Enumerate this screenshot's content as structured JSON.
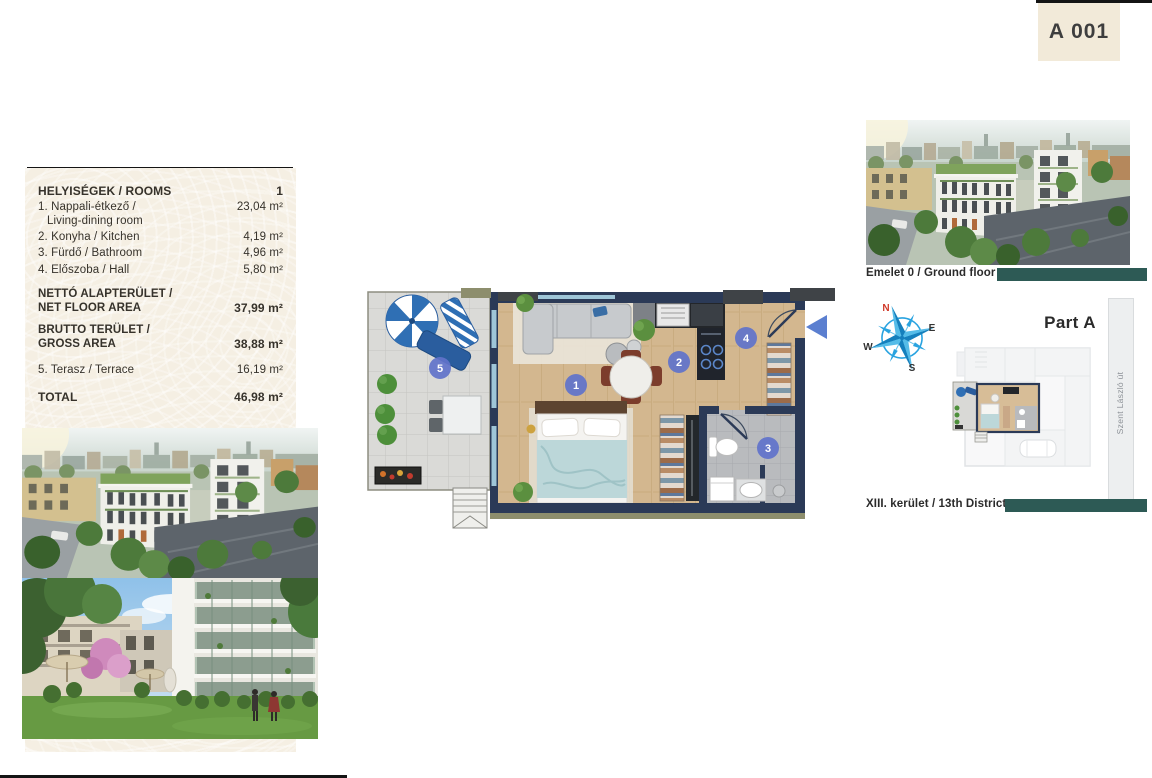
{
  "unit_badge": {
    "label": "A 001"
  },
  "rooms_table": {
    "title": "HELYISÉGEK / ROOMS",
    "unit_number": "1",
    "rows": [
      {
        "label": "1. Nappali-étkező /",
        "sub": "Living-dining room",
        "area": "23,04 m²"
      },
      {
        "label": "2. Konyha / Kitchen",
        "area": "4,19 m²"
      },
      {
        "label": "3. Fürdő / Bathroom",
        "area": "4,96 m²"
      },
      {
        "label": "4. Előszoba / Hall",
        "area": "5,80 m²"
      }
    ],
    "net": {
      "line1": "NETTÓ ALAPTERÜLET /",
      "line2": "NET FLOOR AREA",
      "area": "37,99 m²"
    },
    "gross": {
      "line1": "BRUTTO TERÜLET /",
      "line2": "GROSS AREA",
      "area": "38,88 m²"
    },
    "terrace": {
      "label": "5. Terasz / Terrace",
      "area": "16,19 m²"
    },
    "total": {
      "label": "TOTAL",
      "area": "46,98 m²"
    }
  },
  "floor_plan": {
    "markers": [
      {
        "n": "1",
        "room": "living-dining"
      },
      {
        "n": "2",
        "room": "kitchen"
      },
      {
        "n": "3",
        "room": "bathroom"
      },
      {
        "n": "4",
        "room": "hall"
      },
      {
        "n": "5",
        "room": "terrace"
      }
    ]
  },
  "right_panel": {
    "ground_floor_caption": "Emelet 0 / Ground floor",
    "district_caption": "XIII. kerület / 13th District",
    "part_label": "Part A",
    "street_label": "Szent László út",
    "compass": {
      "n": "N",
      "e": "E",
      "s": "S",
      "w": "W"
    }
  },
  "colors": {
    "accent_teal": "#2d5a55",
    "panel_beige": "#f5efe3",
    "wall_navy": "#2b3a57",
    "marker_blue": "#6173ca",
    "north_red": "#d03a2a",
    "compass_blue": "#29a3e0"
  }
}
